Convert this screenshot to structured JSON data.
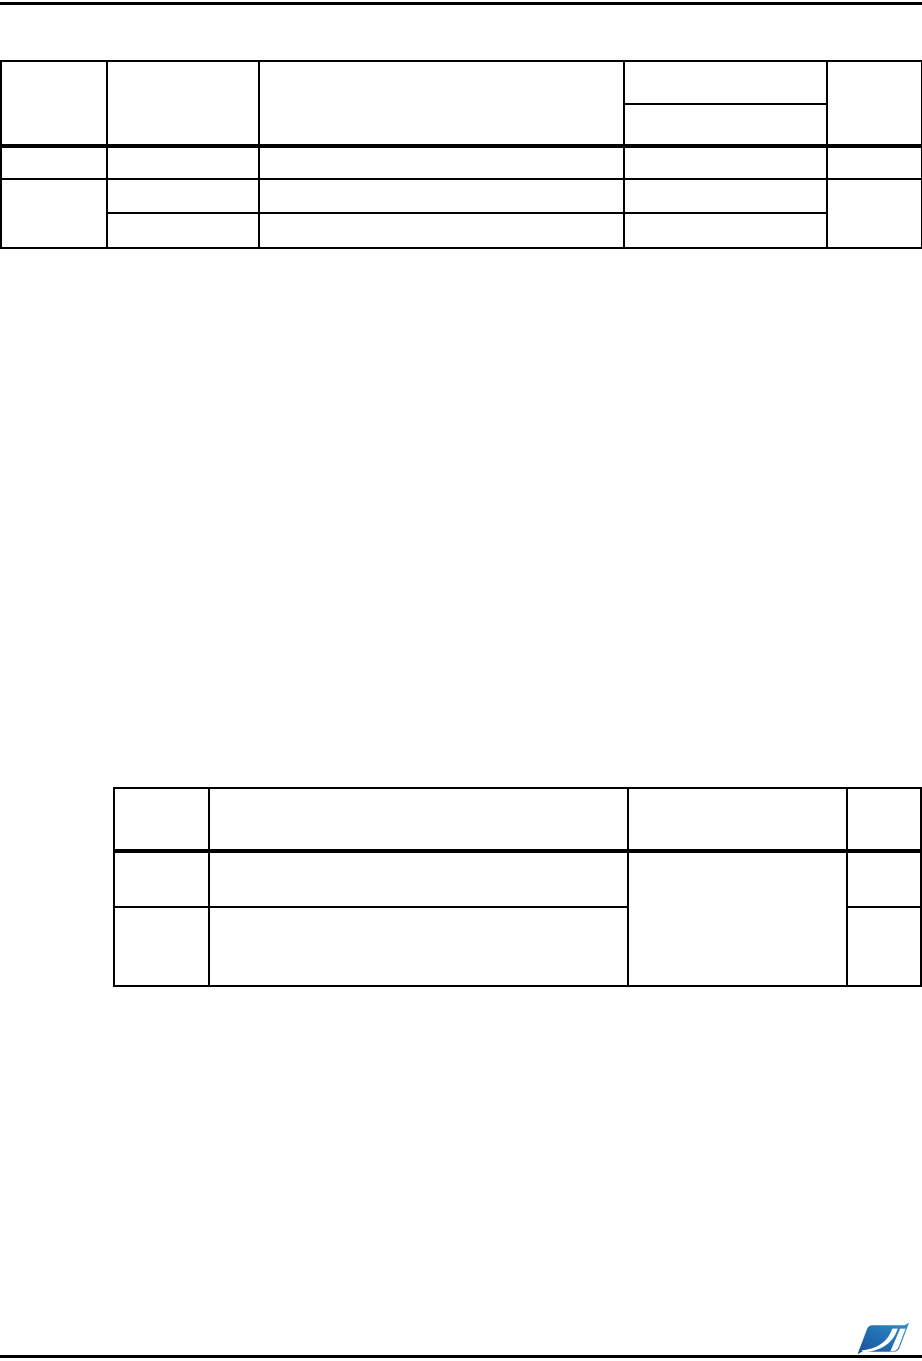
{
  "page": {
    "background": "#ffffff",
    "rule_color": "#000000",
    "content_note": ""
  },
  "top_table": {
    "columns": 5,
    "header_rows": 2,
    "body_rows": 3,
    "cell_text": ""
  },
  "middle_table": {
    "columns": 4,
    "header_rows": 1,
    "body_rows": 2,
    "cell_text": ""
  },
  "logo": {
    "blue_dark": "#17519a",
    "blue_light": "#2f8fcc",
    "white": "#ffffff"
  }
}
